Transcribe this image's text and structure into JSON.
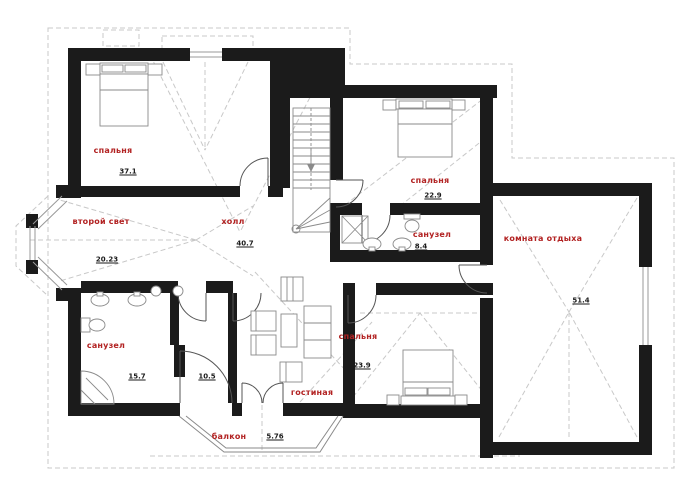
{
  "rooms": [
    {
      "id": "bedroom-topleft",
      "name": "спальня",
      "area": "37.1"
    },
    {
      "id": "second-light",
      "name": "второй свет",
      "area": "20.23"
    },
    {
      "id": "hall",
      "name": "холл",
      "area": "40.7"
    },
    {
      "id": "bedroom-topright",
      "name": "спальня",
      "area": "22.9"
    },
    {
      "id": "bathroom-middle",
      "name": "санузел",
      "area": "8.4"
    },
    {
      "id": "lounge",
      "name": "комната отдыха",
      "area": "51.4"
    },
    {
      "id": "bathroom-left",
      "name": "санузел",
      "area": "15.7"
    },
    {
      "id": "storage",
      "name": "",
      "area": "10.5"
    },
    {
      "id": "living",
      "name": "гостиная",
      "area": ""
    },
    {
      "id": "bedroom-bottom",
      "name": "спальня",
      "area": "23.9"
    },
    {
      "id": "balcony",
      "name": "балкон",
      "area": "5.76"
    }
  ],
  "colors": {
    "label_red": "#b22222",
    "wall_black": "#1b1b1b",
    "furniture_gray": "#8a8a8a",
    "roof_dash_gray": "#c8c8c8"
  }
}
